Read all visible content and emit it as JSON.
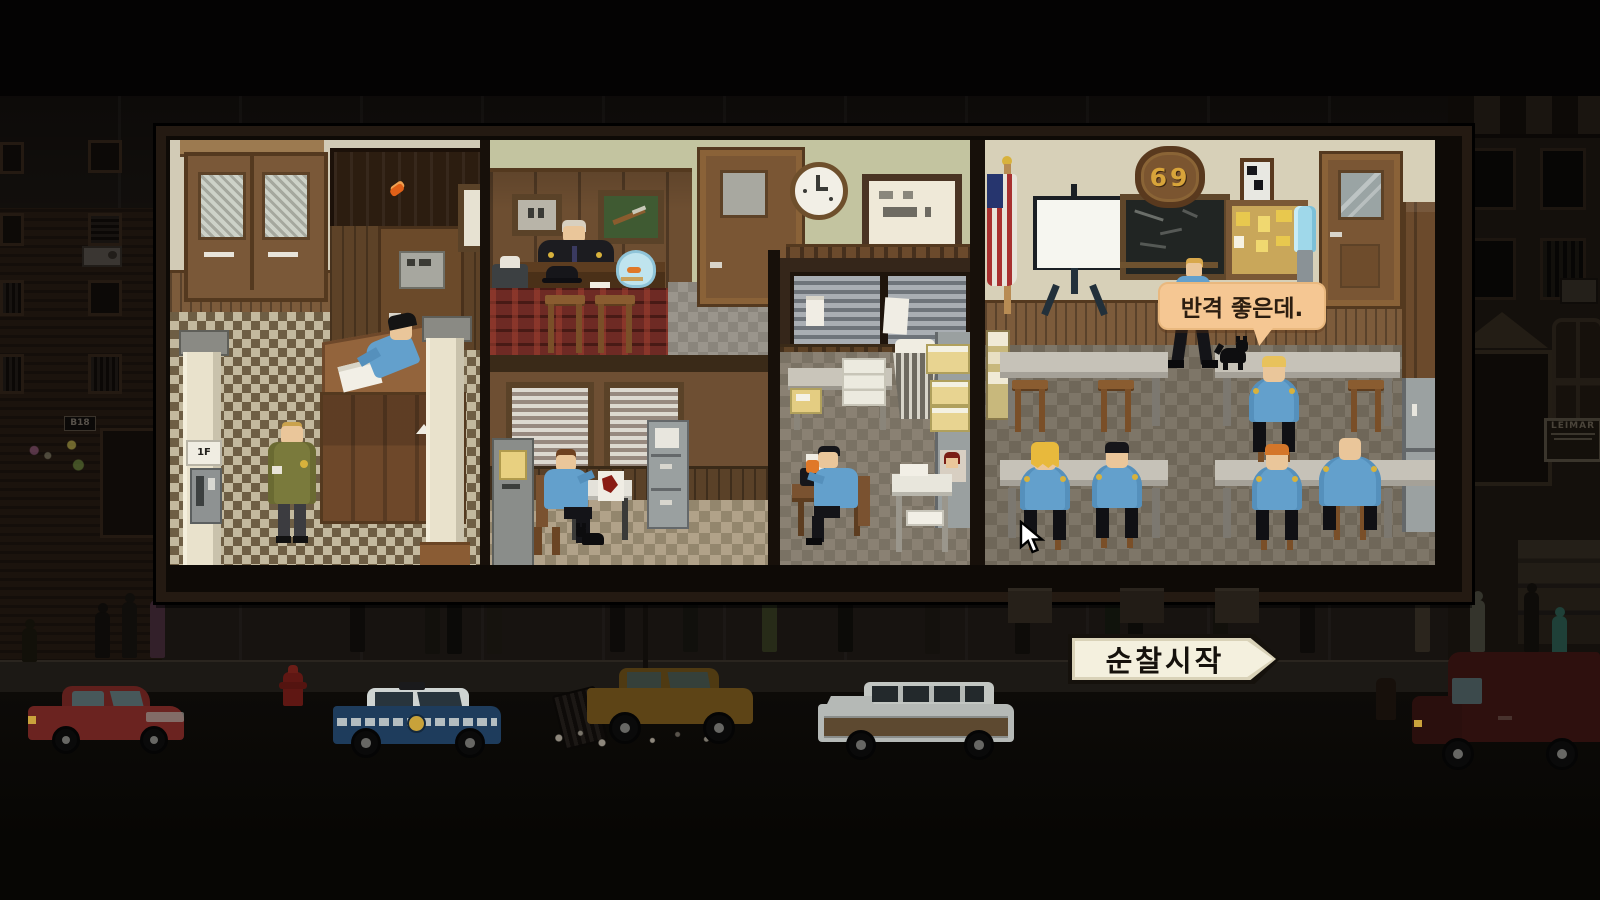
{
  "hud": {
    "patrol_button": {
      "label": "순찰시작"
    },
    "speech_bubble": {
      "text": "반격 좋은데."
    },
    "precinct_plaque": {
      "number": "69"
    },
    "street_sign": {
      "text": "LEIMAR"
    },
    "building_number": {
      "text": "B18"
    }
  },
  "palette": {
    "officer_blue": "#63a0cc",
    "skin": "#eac69a",
    "bubble": "#f5c793",
    "button_face": "#f4f0de",
    "plaque_gold": "#d8a43a",
    "wall_cream": "#d5ceba",
    "wall_green": "#c3c4a0",
    "carpet_red": "#6e2a24",
    "police_car": "#1e3c5c",
    "red_car": "#6b2320",
    "wagon_silver": "#b5b9b6",
    "van_maroon": "#2e100e"
  },
  "scene": {
    "rooms": [
      "lobby",
      "captain-office",
      "detective-office",
      "storage-room",
      "briefing-room"
    ],
    "pedestrians": [
      {
        "x": 22,
        "y": 628,
        "h": 34,
        "c": "#121009"
      },
      {
        "x": 95,
        "y": 612,
        "h": 46,
        "c": "#0d0b09"
      },
      {
        "x": 122,
        "y": 602,
        "h": 56,
        "c": "#100e0b"
      },
      {
        "x": 150,
        "y": 600,
        "h": 58,
        "c": "#33202a"
      },
      {
        "x": 350,
        "y": 592,
        "h": 60,
        "c": "#0d0b09"
      },
      {
        "x": 425,
        "y": 596,
        "h": 58,
        "c": "#12100c"
      },
      {
        "x": 447,
        "y": 600,
        "h": 54,
        "c": "#0b0a08"
      },
      {
        "x": 487,
        "y": 602,
        "h": 52,
        "c": "#16130e"
      },
      {
        "x": 610,
        "y": 592,
        "h": 60,
        "c": "#0d0b09"
      },
      {
        "x": 683,
        "y": 596,
        "h": 56,
        "c": "#11100c"
      },
      {
        "x": 762,
        "y": 594,
        "h": 58,
        "c": "#272b18"
      },
      {
        "x": 838,
        "y": 590,
        "h": 62,
        "c": "#0c0b08"
      },
      {
        "x": 925,
        "y": 600,
        "h": 54,
        "c": "#14110d"
      },
      {
        "x": 1015,
        "y": 596,
        "h": 58,
        "c": "#0e0c09"
      },
      {
        "x": 1105,
        "y": 592,
        "h": 60,
        "c": "#10130c"
      },
      {
        "x": 1128,
        "y": 600,
        "h": 52,
        "c": "#0c0b08"
      },
      {
        "x": 1213,
        "y": 590,
        "h": 62,
        "c": "#12100b"
      },
      {
        "x": 1300,
        "y": 598,
        "h": 55,
        "c": "#0d0b09"
      },
      {
        "x": 1415,
        "y": 594,
        "h": 58,
        "c": "#2b251d"
      },
      {
        "x": 1470,
        "y": 600,
        "h": 52,
        "c": "#34342c"
      },
      {
        "x": 1524,
        "y": 592,
        "h": 60,
        "c": "#0e0c09"
      },
      {
        "x": 1552,
        "y": 616,
        "h": 40,
        "c": "#1f4038"
      }
    ],
    "briefing_officers": [
      {
        "x": 1247,
        "y": 352,
        "hair": "#e8c25c",
        "style": "short",
        "big": false
      },
      {
        "x": 1018,
        "y": 440,
        "hair": "#e8b93c",
        "style": "long",
        "big": false
      },
      {
        "x": 1090,
        "y": 438,
        "hair": "#16161a",
        "style": "short",
        "big": false
      },
      {
        "x": 1250,
        "y": 440,
        "hair": "#d4762a",
        "style": "short",
        "big": false
      },
      {
        "x": 1318,
        "y": 430,
        "hair": "none",
        "style": "bald",
        "big": true
      }
    ],
    "empty_stools": [
      {
        "x": 1012,
        "y": 380
      },
      {
        "x": 1098,
        "y": 380
      },
      {
        "x": 1348,
        "y": 380
      }
    ],
    "cars": [
      "red-hatchback",
      "police-cruiser",
      "abandoned-sedan",
      "station-wagon",
      "maroon-van"
    ]
  }
}
